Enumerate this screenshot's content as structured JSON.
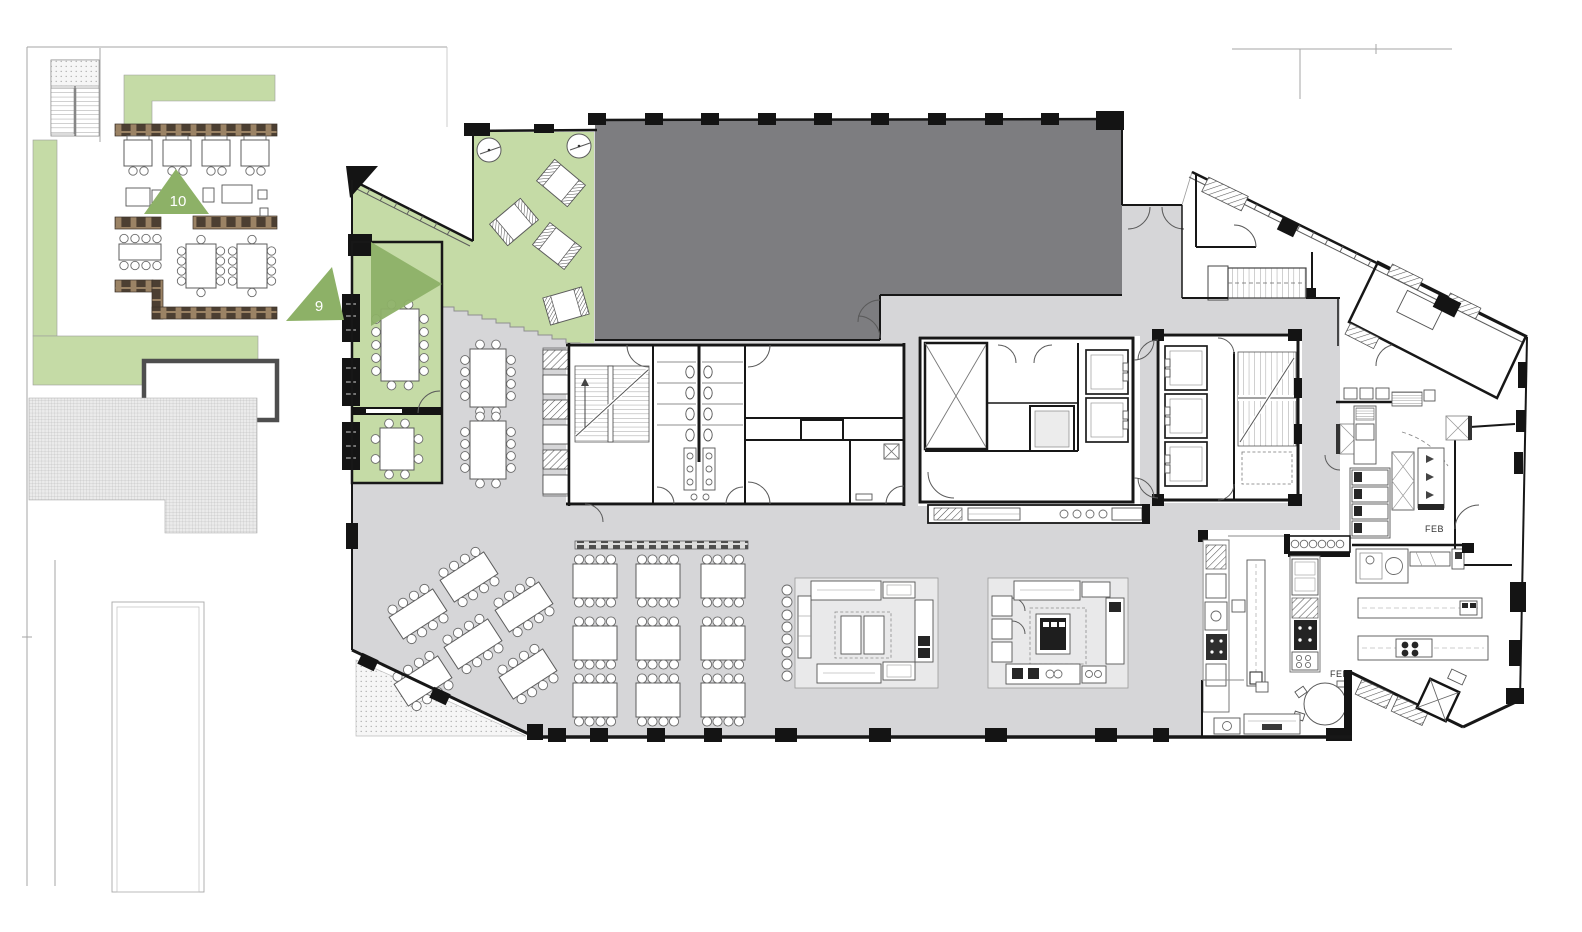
{
  "annotations": {
    "marker_10": "10",
    "marker_9": "9",
    "feb_upper": "FEB",
    "feb_lower": "FEB"
  },
  "colors": {
    "greenery": "#c5dba6",
    "marker_green": "#8db167",
    "floor_gray": "#d6d6d8",
    "shell_gray": "#7d7d80",
    "wall_black": "#171717",
    "bench_brown": "#9b8365",
    "paving_gray": "#ebebeb"
  }
}
